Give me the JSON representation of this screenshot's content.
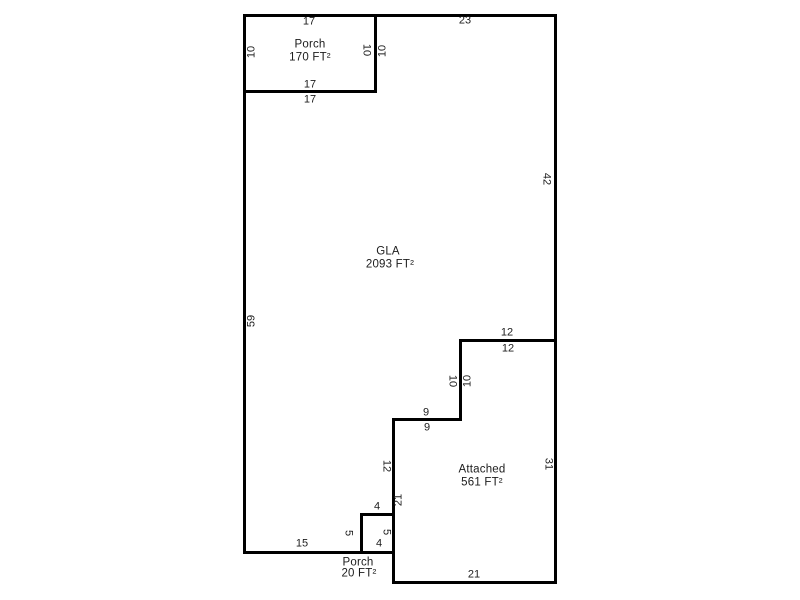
{
  "colors": {
    "background": "#ffffff",
    "wall": "#000000",
    "text": "#1c1c1c"
  },
  "areas": [
    {
      "name": "Porch",
      "size": "170 FT²"
    },
    {
      "name": "GLA",
      "size": "2093 FT²"
    },
    {
      "name": "Attached",
      "size": "561 FT²"
    },
    {
      "name": "Porch",
      "size": "20 FT²"
    }
  ],
  "dimensions": [
    "17",
    "23",
    "10",
    "10",
    "10",
    "17",
    "17",
    "42",
    "59",
    "12",
    "12",
    "10",
    "10",
    "9",
    "9",
    "12",
    "31",
    "21",
    "4",
    "5",
    "5",
    "4",
    "15",
    "21"
  ]
}
